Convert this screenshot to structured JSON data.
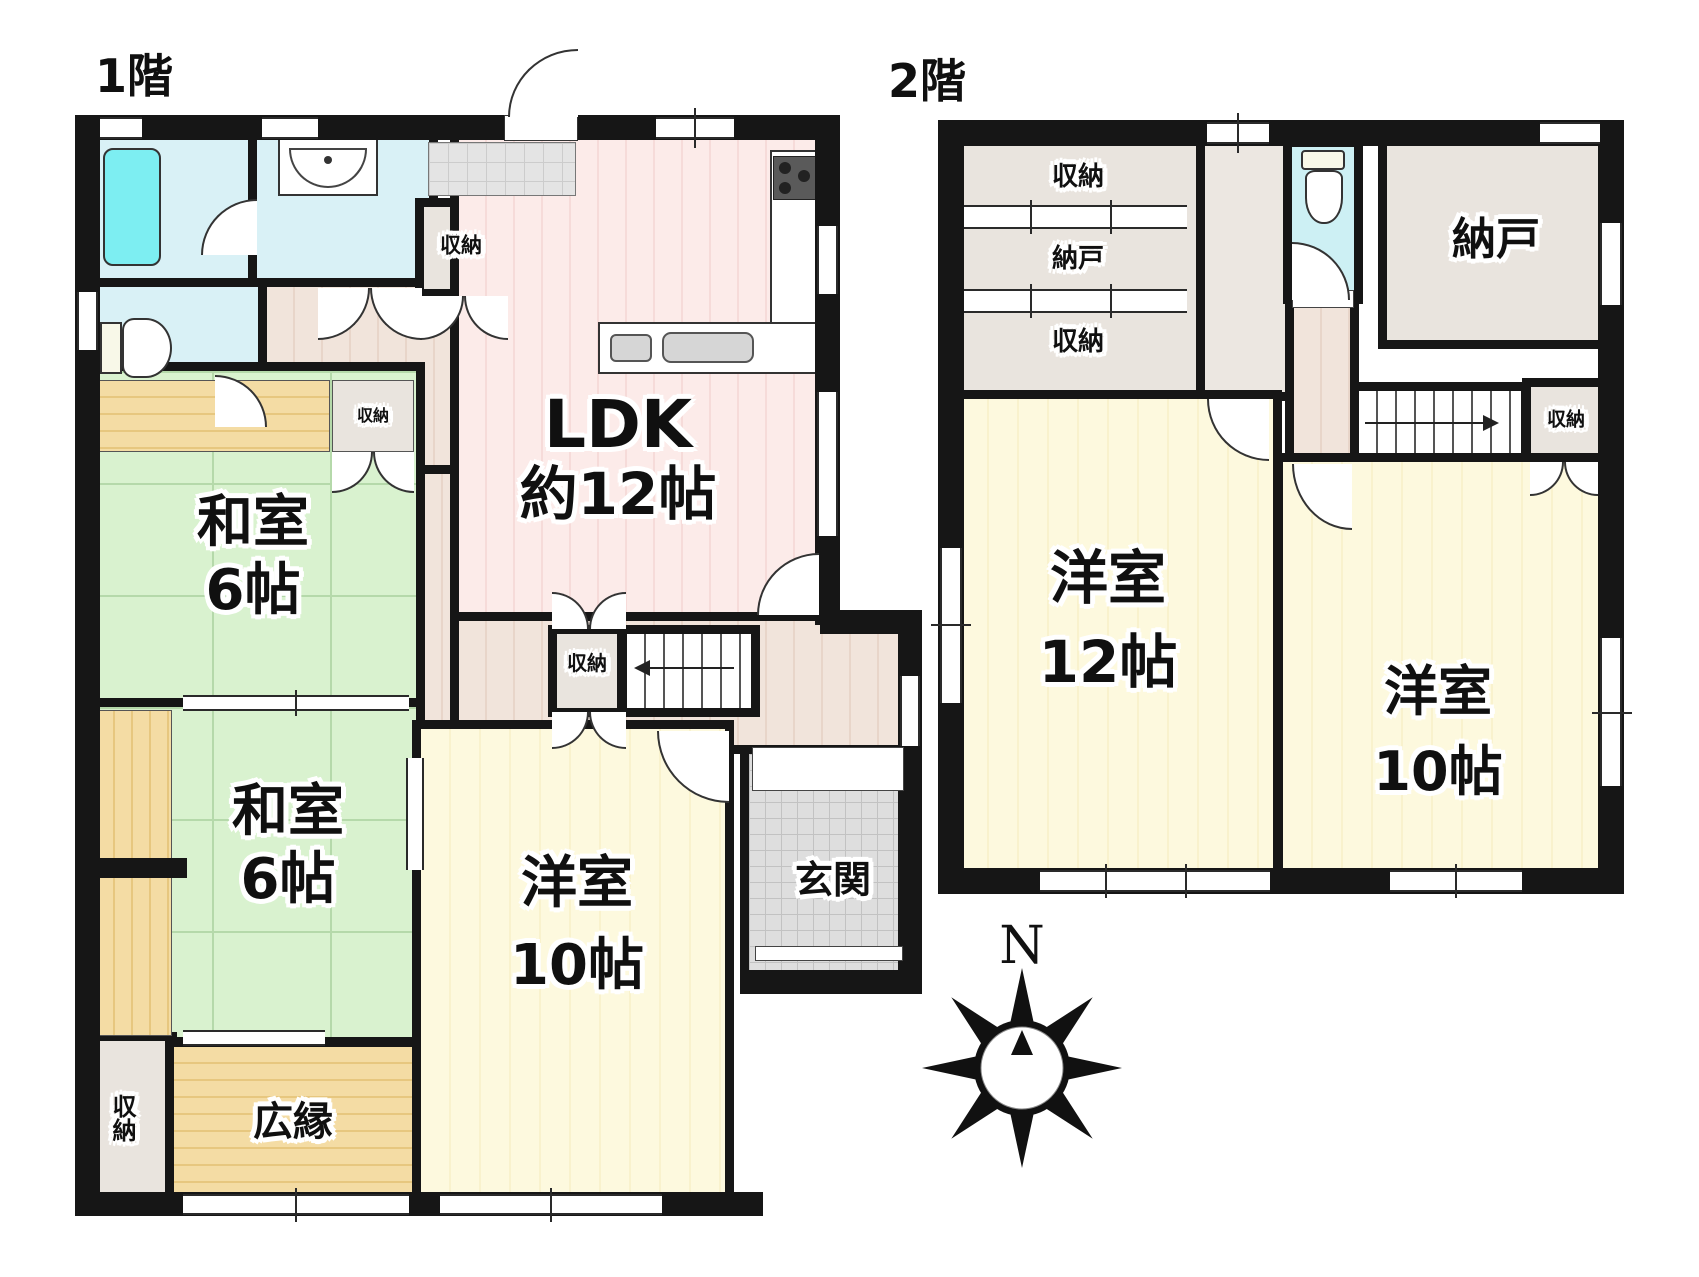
{
  "floor1": {
    "title": "1階"
  },
  "floor2": {
    "title": "2階"
  },
  "labels": {
    "ldk": "LDK",
    "ldk_size": "約12帖",
    "washitsu": "和室",
    "washitsu_size": "6帖",
    "youshitsu": "洋室",
    "size_10": "10帖",
    "size_12": "12帖",
    "storage": "収納",
    "nando": "納戸",
    "genkan": "玄関",
    "hiroen": "広縁"
  },
  "compass": {
    "north": "N"
  },
  "colors": {
    "wall": "#161616",
    "tatami_green": "#d9f2cf",
    "bath_blue": "#d9f1f6",
    "tub_cyan": "#7deef2",
    "ldk_pink": "#fcebe9",
    "hall_beige": "#f1e4db",
    "room_pale_yellow": "#fdf9de",
    "wood_tan": "#f4dca4",
    "storage_grey": "#e9e4de",
    "entry_tile_grey": "#dedede"
  }
}
